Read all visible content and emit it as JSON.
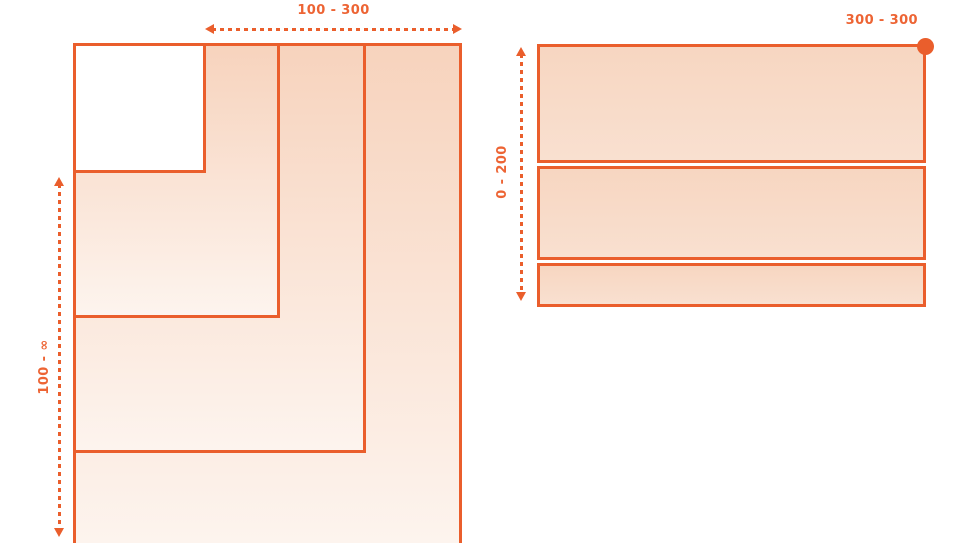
{
  "figure": {
    "accent_color": "#EA5E2C",
    "fill_gradient_top": "#F7D3BD",
    "fill_gradient_bottom": "#FDF4EE",
    "band_fill": "#F8DCC9",
    "left_diagram": {
      "width_range_label": "100 - 300",
      "height_range_label": "100 - ∞"
    },
    "right_diagram": {
      "height_range_label": "0 - 200",
      "size_label": "300 - 300"
    }
  }
}
